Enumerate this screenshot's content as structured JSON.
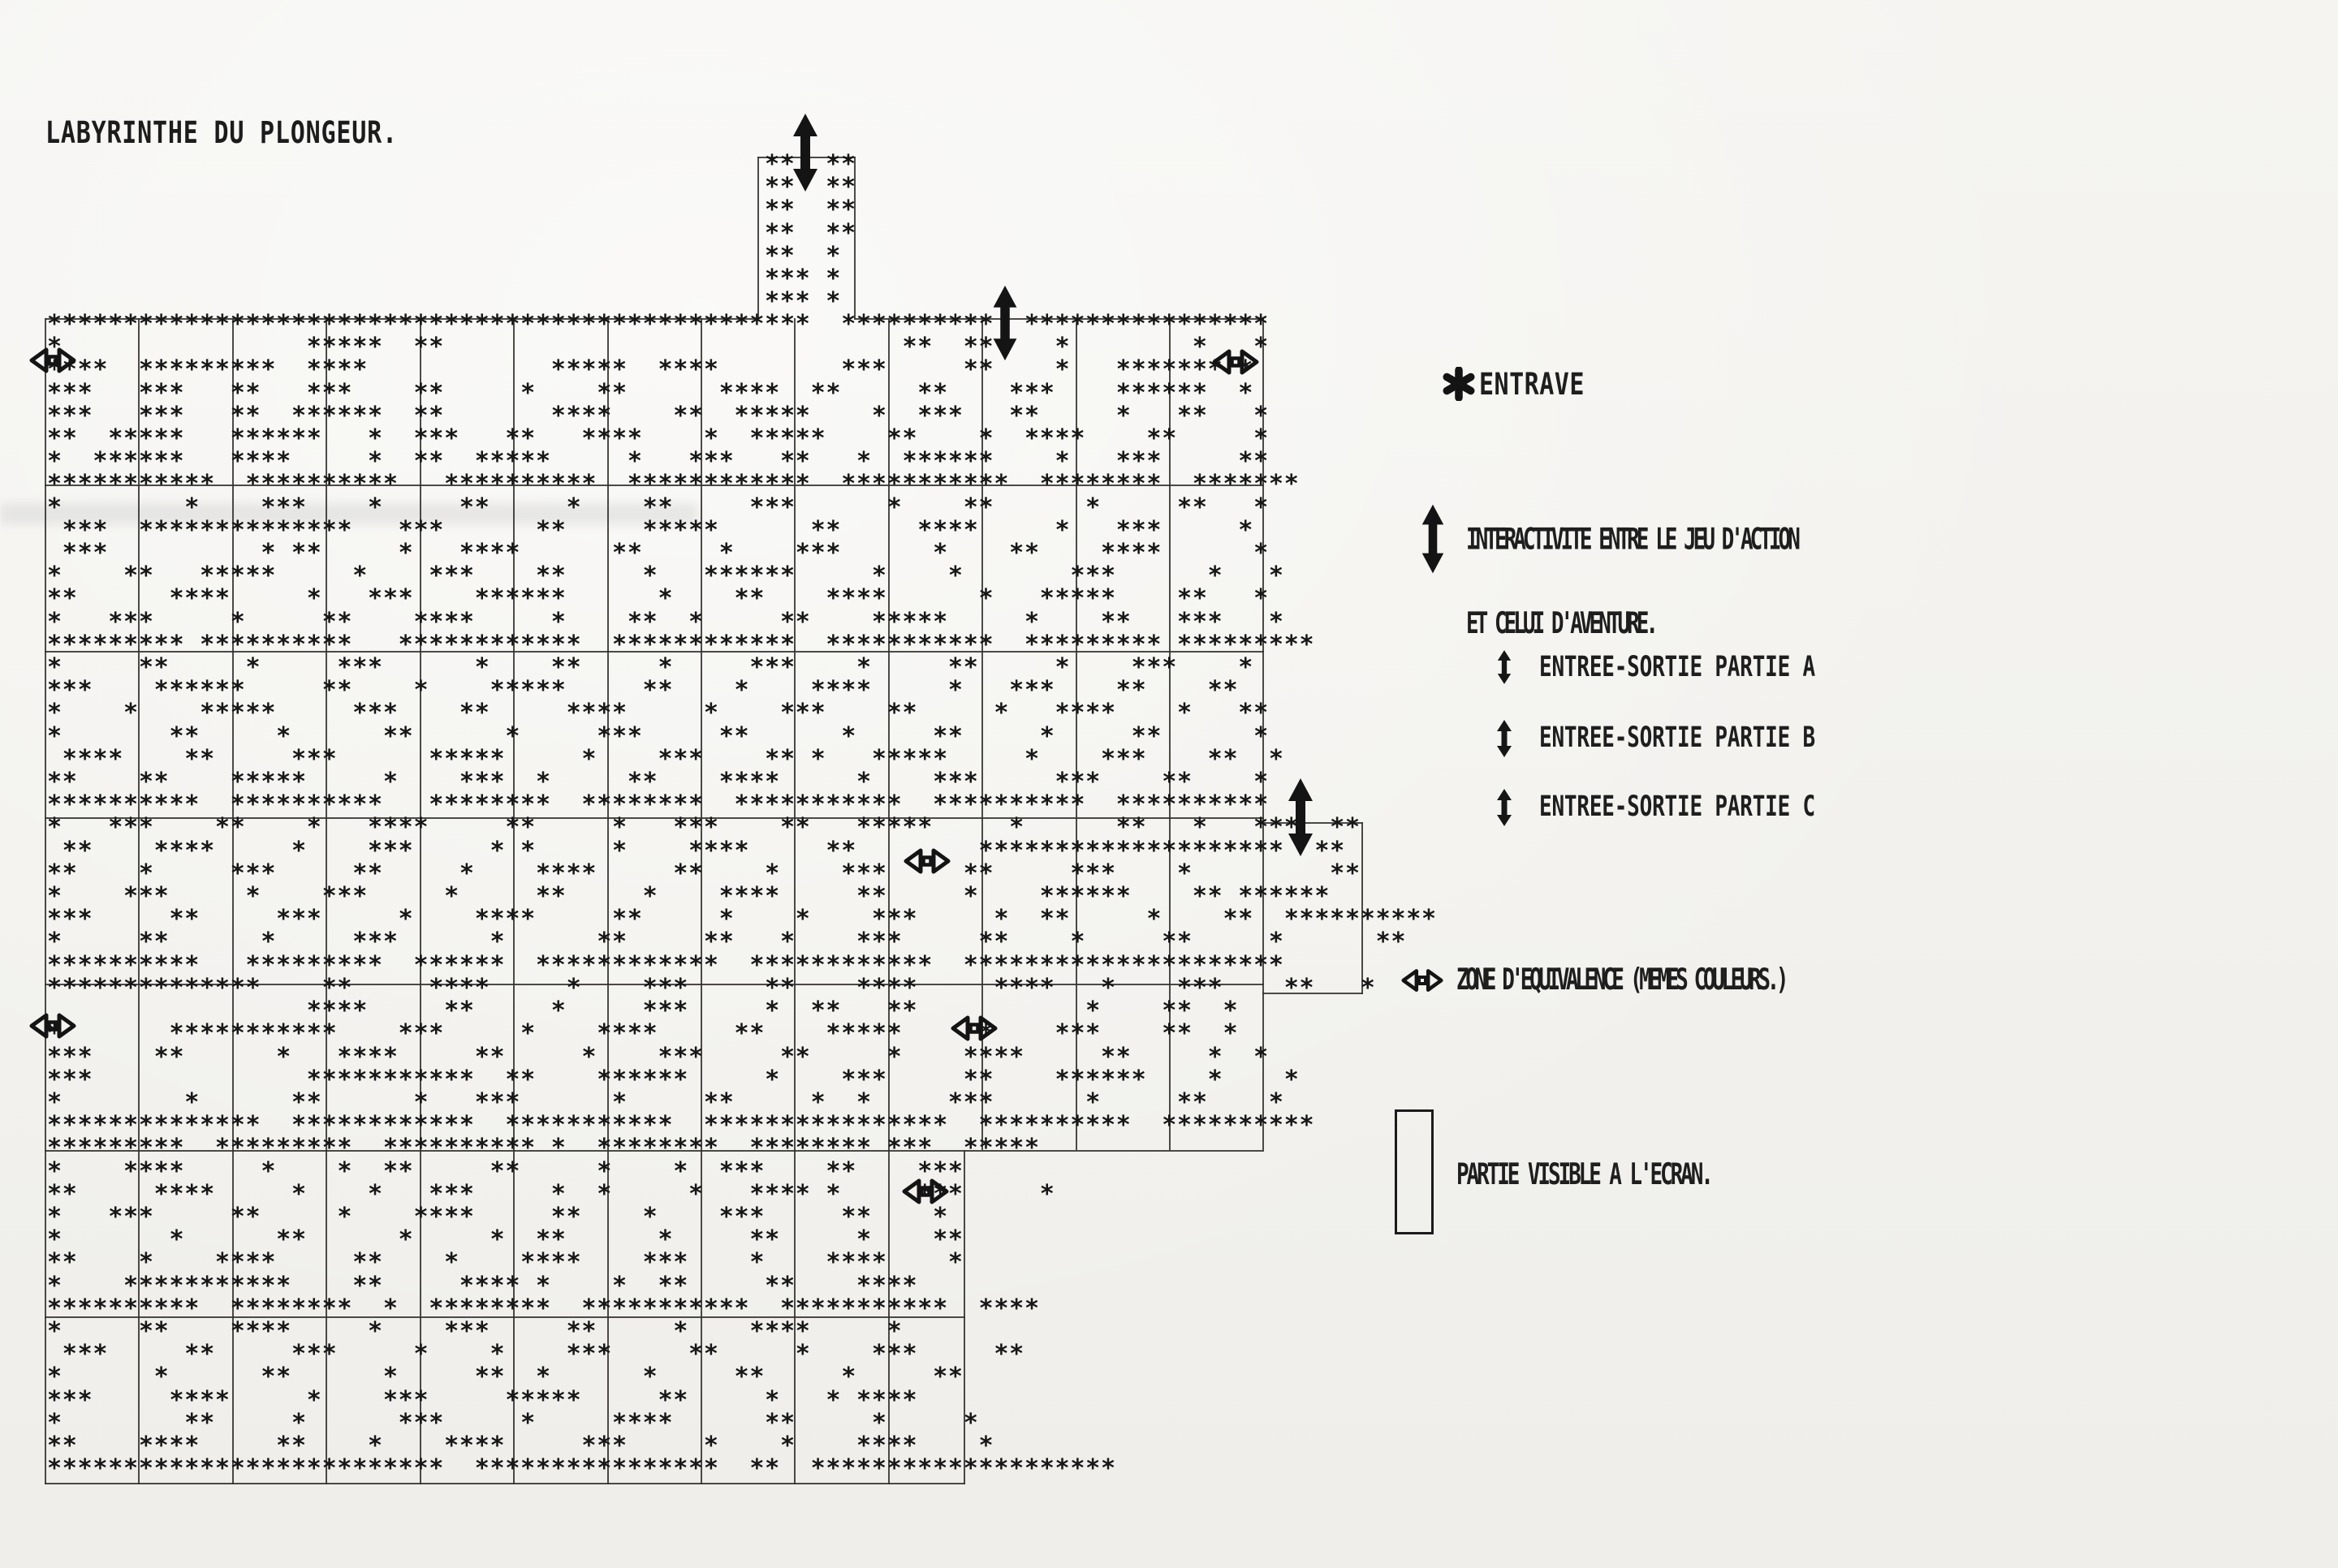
{
  "page": {
    "title": "LABYRINTHE DU PLONGEUR.",
    "paper_color": "#f4f3f0",
    "ink_color": "#1a1a1a"
  },
  "legend": {
    "entrave": {
      "icon": "heavy-asterisk-icon",
      "label": "ENTRAVE"
    },
    "interactivite": {
      "icon": "large-double-vertical-arrow-icon",
      "line1": "INTERACTIVITE ENTRE LE JEU D'ACTION",
      "line2": "ET CELUI D'AVENTURE."
    },
    "entrees": [
      {
        "icon": "double-vertical-arrow-icon",
        "label": "ENTREE-SORTIE PARTIE A"
      },
      {
        "icon": "double-vertical-arrow-icon",
        "label": "ENTREE-SORTIE PARTIE B"
      },
      {
        "icon": "double-vertical-arrow-icon",
        "label": "ENTREE-SORTIE PARTIE C"
      }
    ],
    "zone": {
      "icon": "double-horizontal-arrow-outline-icon",
      "label": "ZONE D'EQUIVALENCE (MEMES COULEURS.)"
    },
    "partie_visible": {
      "icon": "rectangle-outline-icon",
      "label": "PARTIE VISIBLE A L'ECRAN."
    }
  },
  "maze": {
    "wall_char": "*",
    "chimney_rows": [
      "**  **",
      "**  **",
      "**  **",
      "**  **",
      "**  * ",
      "*** * ",
      "*** * "
    ],
    "rows": [
      "**************************************************  **********  ****************",
      "*                *****  **                              **  **    *        *   *",
      "****  *********  ****            *****  ****        ***     **    *   ******* * ",
      "***   ***   **   ***    **     *    **      ****  **     **    ***    ******  * ",
      "***   ***   **  ******  **       ****    **  *****    *  ***   **     *   **   *",
      "**  *****   ******   *  ***   **   ****    *  *****    **    *  ****    **     *",
      "*  ******   ****     *  **  *****     *   ***   **   *  ******    *   ***     **",
      "***********  **********   **********  ************  ***********  ********  *******",
      "*        *    ***    *     **     *    **     ***      *    **      *     **   *",
      " ***  **************   ***      **     *****      **     ****     *   ***     *",
      " ***          * **     *   ****      **     *    ***      *    **    ****      *",
      "*    **   *****     *    ***    **     *   ******     *    *       ***      *   *",
      "**      ****     *   ***    ******      *    **    ****      *   *****    **   *",
      "*   ***     *     **    ****     *    **  *     **    *****     *    **   ***   *",
      "********* **********   ************  ************  ***********  ********* *********",
      "*     **     *     ***      *    **     *     ***    *     **     *    ***    *",
      "***    ******     **    *    *****     **    *    ****     *   ***    **    **  ",
      "*    *    *****     ***    **     ****     *    ***    **     *   ****    *   **",
      "*       **     *      **      *     ***     **      *     **     *     **      *",
      " ****    **     ***      *****     *    ***    ** *   *****     *    ***    **  *",
      "**    **    *****     *    ***  *     **    ****     *    ***     ***    **    *  ",
      "**********  **********   ********  ********  ***********  **********  **********",
      "*   ***    **    *   ****     **     *   ***    **   *****     *      **   *   ***  ** ",
      " **    ****     *    ***     * *     *    ****     **        ********************  ** ",
      "**    *     ***     **     *    ****     **    *    ***     **     ***    *         ** ",
      "*    ***     *    ***     *     **     *    ****     **     *    ******    ** ****** ",
      "***     **     ***     *    ****     **     *    *    ***     *  **     *    **  ********** ",
      "*     **      *     ***      *      **     **   *    ***     **    *     **     *      ** ",
      "**********   *********  ******  ************  ************  ********************* ",
      "**************    **     ****     *    ***     **    ****     ****   *    ***    **   *",
      "                 ****     **     *     ***     *  **   **           *    **  *",
      "*       ***********    ***     *    ****     **    *****     *    ***    **  *",
      "***    **      *   ****     **     *    ***     **     *    ****     **     *  *",
      "***              ***********  **    ******     *    ***     **    ******    *    *",
      "*        *      **      *   ***      *     **     *  *     ***      *     **    *",
      "**************  ************  ***********  ****************  **********  **********",
      "*********  *********  ********** *  ********  ******** ***  *****",
      "*    ****     *    *  **     **     *    *  ***    **    ***    ",
      "**     ****     *    *   ***     *  *     *   **** *     ***     * ",
      "*   ***     **     *    ****     **    *    ***     **    *",
      "*       *      **      *     *  **      *     **     *    **  ",
      "**    *    ****     **    *    ****    ***    *    ****    *",
      "*    ***********    **     **** *    *  **     **    ****   ",
      "**********  ********  *  ********  ***********  ***********  ****",
      "*     **    ****     *    ***     **     *    ****     *    ",
      " ***     **     ***     *    *    ***     **     *    ***     **",
      "*      *      **      *     **  *      *     **     *     **  ",
      "***     ****     *    ***     *****     **     *   * ****     ",
      "*        **     *      ***     *     ****      **     *     * ",
      "**    ****     **    *    ****     ***     *    *    ****    *  ",
      "**************************  ****************  **  ********************"
    ],
    "rules": [
      [
        55,
        392,
        2,
        1025
      ],
      [
        170,
        392,
        2,
        1025
      ],
      [
        286,
        392,
        2,
        1025
      ],
      [
        401,
        392,
        2,
        1025
      ],
      [
        517,
        392,
        2,
        1025
      ],
      [
        632,
        392,
        2,
        1025
      ],
      [
        748,
        392,
        2,
        1025
      ],
      [
        863,
        392,
        2,
        1025
      ],
      [
        978,
        392,
        2,
        1025
      ],
      [
        1094,
        392,
        2,
        1025
      ],
      [
        1209,
        392,
        2,
        1025
      ],
      [
        1325,
        392,
        2,
        1025
      ],
      [
        1440,
        392,
        2,
        1025
      ],
      [
        1555,
        392,
        2,
        1025
      ],
      [
        55,
        1417,
        2,
        412
      ],
      [
        170,
        1417,
        2,
        412
      ],
      [
        286,
        1417,
        2,
        412
      ],
      [
        401,
        1417,
        2,
        412
      ],
      [
        517,
        1417,
        2,
        412
      ],
      [
        632,
        1417,
        2,
        412
      ],
      [
        748,
        1417,
        2,
        412
      ],
      [
        863,
        1417,
        2,
        412
      ],
      [
        978,
        1417,
        2,
        412
      ],
      [
        1094,
        1417,
        2,
        412
      ],
      [
        1187,
        1417,
        2,
        412
      ],
      [
        933,
        193,
        2,
        200
      ],
      [
        1052,
        193,
        2,
        200
      ],
      [
        1677,
        1013,
        2,
        212
      ],
      [
        55,
        392,
        880,
        2
      ],
      [
        1052,
        392,
        505,
        2
      ],
      [
        55,
        597,
        1502,
        2
      ],
      [
        55,
        802,
        1502,
        2
      ],
      [
        55,
        1007,
        1502,
        2
      ],
      [
        55,
        1212,
        1502,
        2
      ],
      [
        55,
        1417,
        1502,
        2
      ],
      [
        55,
        1622,
        1134,
        2
      ],
      [
        55,
        1827,
        1134,
        2
      ],
      [
        933,
        193,
        121,
        2
      ],
      [
        1555,
        1013,
        124,
        2
      ],
      [
        1555,
        1223,
        124,
        2
      ]
    ],
    "symbols": {
      "big_arrows": "interactivity links between action game and adventure game",
      "zone_arrows": "equivalence zones (same colours)",
      "count_big_arrows": 3,
      "count_zone_arrows": 6
    }
  }
}
